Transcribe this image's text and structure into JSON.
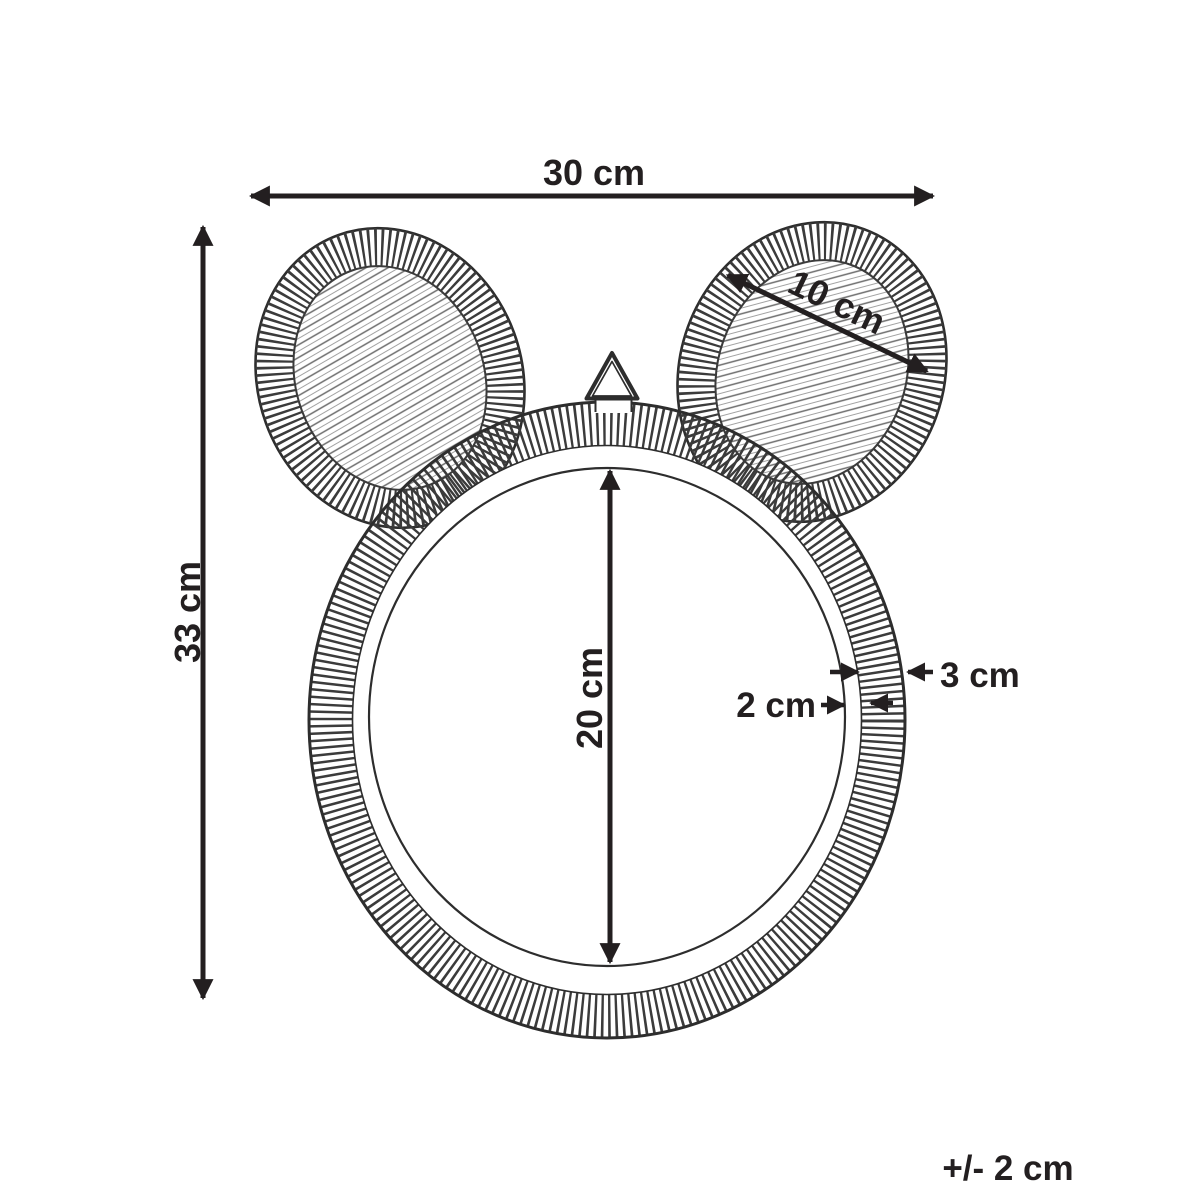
{
  "diagram": {
    "labels": {
      "overall_width": "30 cm",
      "overall_height": "33 cm",
      "ear_width": "10 cm",
      "mirror_diameter": "20 cm",
      "frame_width": "3 cm",
      "inner_rim_width": "2 cm",
      "tolerance": "+/- 2 cm"
    },
    "colors": {
      "ink": "#231f20",
      "outline": "#2d2d2d",
      "hatch": "#3b3b3b",
      "weave": "#6e6e6e",
      "weave_light": "#a3a3a3",
      "background": "#ffffff"
    }
  }
}
